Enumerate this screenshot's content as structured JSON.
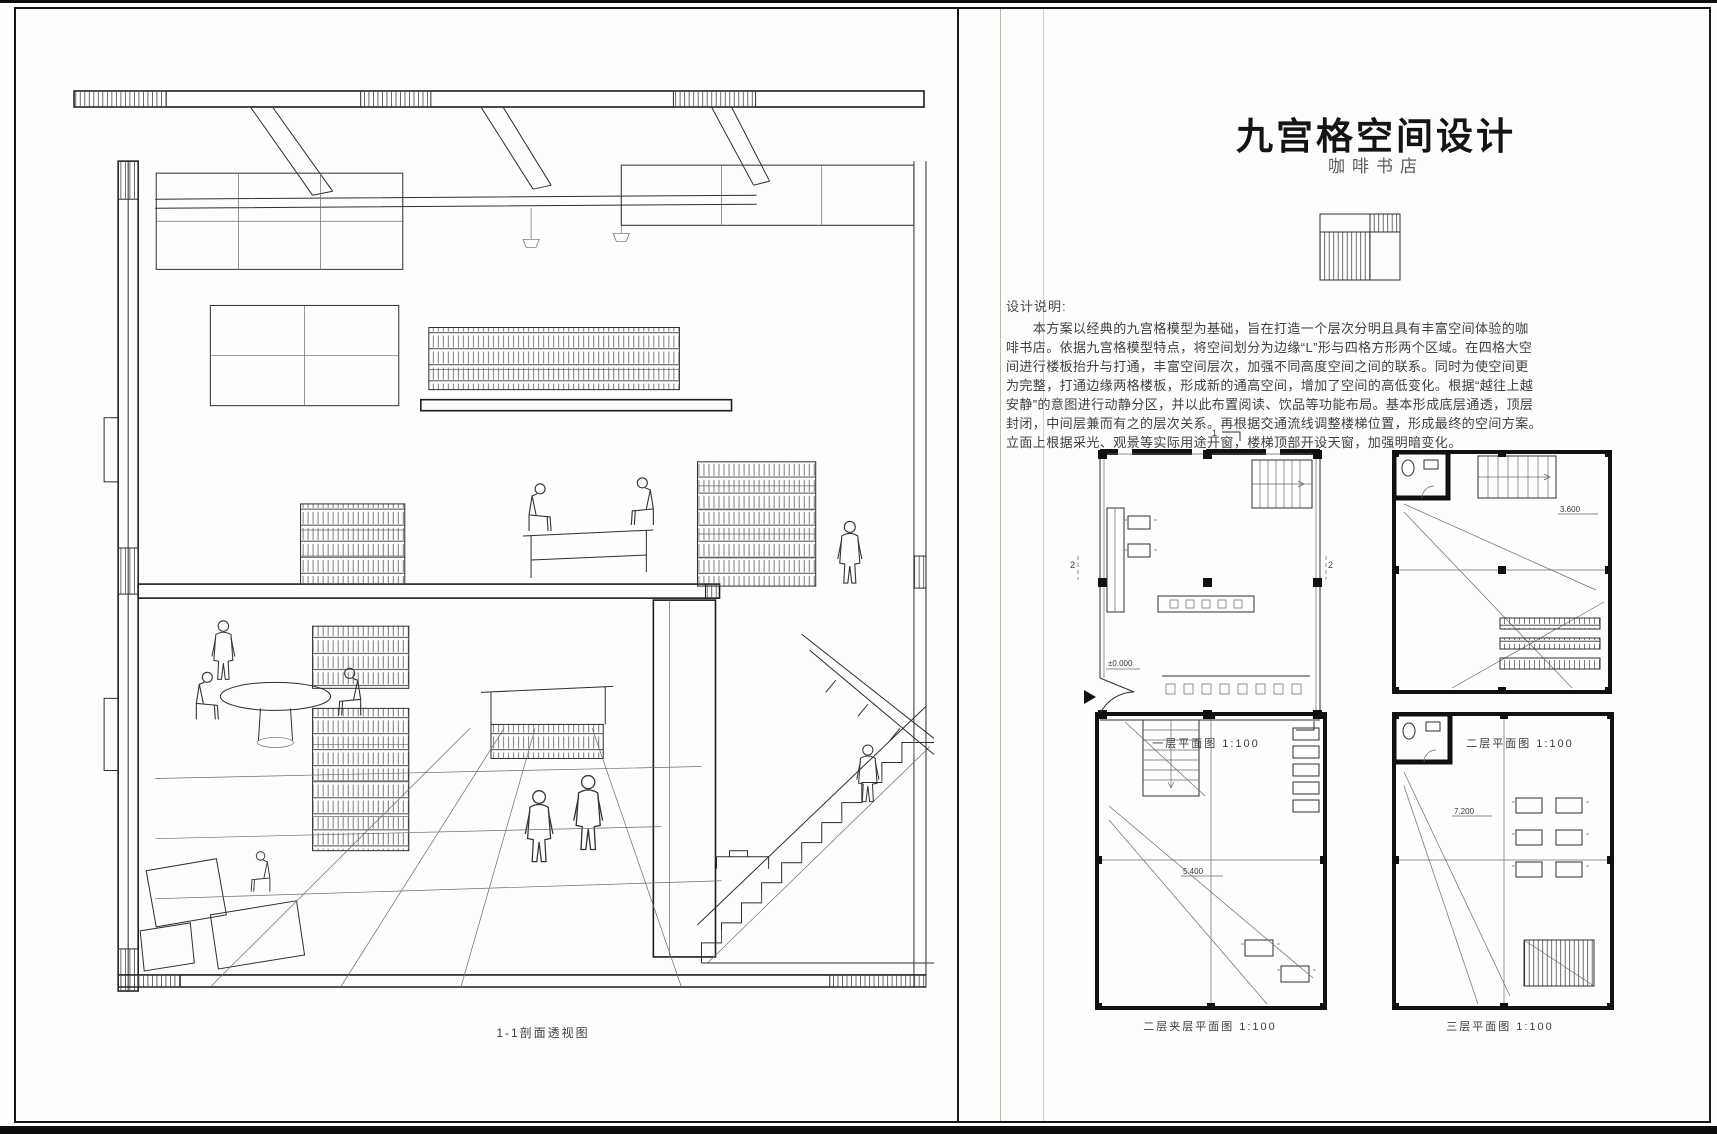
{
  "sheet": {
    "background": "#fdfdfc",
    "ink_color": "#1b1b1b"
  },
  "left_panel": {
    "caption": "1-1剖面透视图"
  },
  "right_panel": {
    "title": "九宫格空间设计",
    "subtitle": "咖啡书店",
    "logo_icon": "ninegrid-hatched-square",
    "design_notes": {
      "heading": "设计说明:",
      "lines": [
        "　　本方案以经典的九宫格模型为基础，旨在打造一个层次分明且具有丰富空间体验的咖",
        "啡书店。依据九宫格模型特点，将空间划分为边缘“L”形与四格方形两个区域。在四格大空",
        "间进行楼板抬升与打通，丰富空间层次，加强不同高度空间之间的联系。同时为使空间更",
        "为完整，打通边缘两格楼板，形成新的通高空间，增加了空间的高低变化。根据“越往上越",
        "安静”的意图进行动静分区，并以此布置阅读、饮品等功能布局。基本形成底层通透，顶层",
        "封闭，中间层兼而有之的层次关系。再根据交通流线调整楼梯位置，形成最终的空间方案。",
        "立面上根据采光、观景等实际用途开窗，楼梯顶部开设天窗，加强明暗变化。"
      ]
    },
    "plans": [
      {
        "caption": "一层平面图 1:100",
        "level": "±0.000"
      },
      {
        "caption": "二层平面图 1:100",
        "level": "3.600"
      },
      {
        "caption": "二层夹层平面图 1:100",
        "level": "5.400"
      },
      {
        "caption": "三层平面图 1:100",
        "level": "7.200"
      }
    ],
    "section_marks": {
      "left": "2",
      "right": "2",
      "top": "1"
    }
  }
}
